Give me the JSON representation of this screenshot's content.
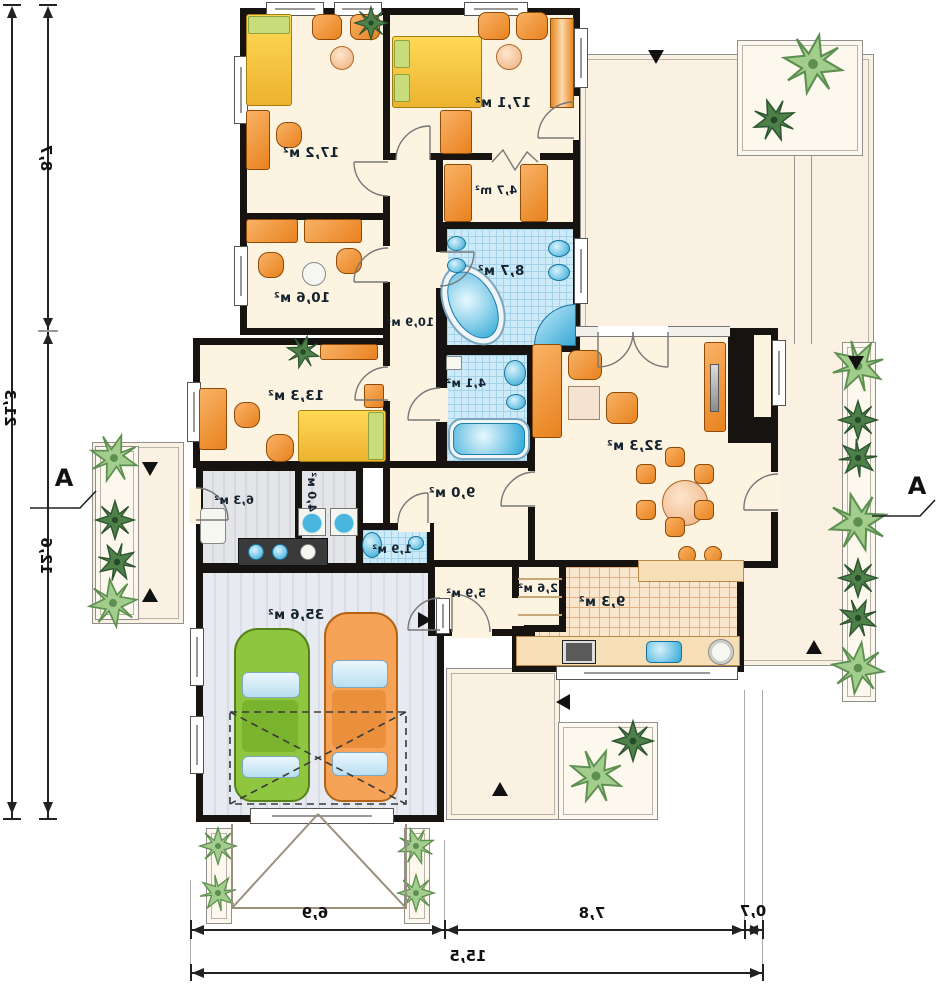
{
  "plan": {
    "rooms": {
      "r172": "17,2 м²",
      "r171": "17,1 м²",
      "r47": "4,7 m²",
      "r106": "10,6 м²",
      "r87": "8,7 м²",
      "r109": "10,9 м²",
      "r133": "13,3 м²",
      "r41": "4,1 м²",
      "r323": "32,3 м²",
      "r90": "9,0 м²",
      "r63": "6,3 м²",
      "r40": "4,0 м²",
      "r19": "1,9 м²",
      "r59": "5,9 м²",
      "r26": "2,6 м²",
      "r93": "9,3 м²",
      "r356": "35,6 м²"
    },
    "dims": {
      "left_total": "21,3",
      "left_top": "8,7",
      "left_bottom": "12,6",
      "bottom_left": "6,9",
      "bottom_mid": "7,8",
      "bottom_right": "0,7",
      "bottom_total": "15,5"
    },
    "section": {
      "left": "A",
      "right": "A"
    },
    "colors": {
      "wall": "#171311",
      "furniture": "#ef8f2f",
      "water": "#45b1da",
      "plant_light": "#a3cd8c",
      "plant_dark": "#4e8049",
      "car_green": "#8ec63f",
      "car_orange": "#f6a257"
    }
  }
}
